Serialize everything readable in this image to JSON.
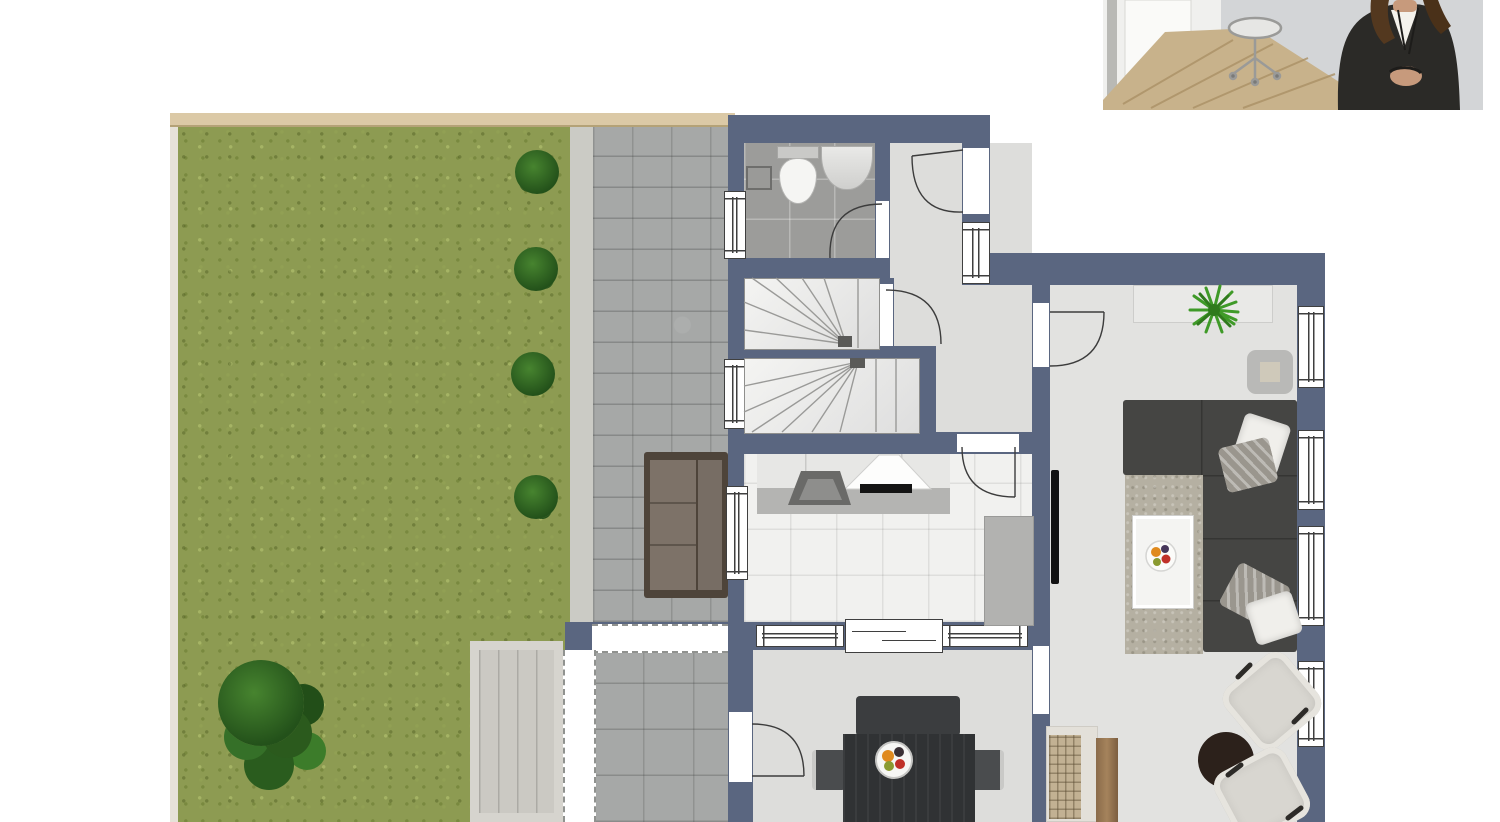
{
  "meta": {
    "kind": "real-estate ground-floor plan with garden and furnished rooms, agent photo inset top-right",
    "visible_text": "none"
  },
  "colors": {
    "wall": "#5a6680",
    "floor": "#dddddb",
    "floorLiving": "#e2e2e0",
    "bathTile": "#9c9c9a",
    "kitchenTile": "#f1f1ef",
    "grass": "#8d9b52",
    "bushDark": "#23511a",
    "bushLight": "#47842f",
    "paver": "#a6a8a7",
    "pathStrip": "#cbcbc5",
    "fence": "#dbc9a6",
    "deck": "#cbc9c3",
    "windowFrame": "#3f3f3f",
    "sofa": "#454543",
    "sofaLine": "#353533",
    "outdoorSofaFrame": "#4e443a",
    "outdoorSofaCushion": "#7d7268",
    "rug": "#b5b0a2",
    "wood": "#8a6b4a",
    "tableDark": "#303234",
    "benchDark": "#3b3d3f",
    "cream": "#d8d6d0",
    "roundTable": "#2c211b",
    "cabinet": "#e7e7e5",
    "counter": "#b4b4b2",
    "appliance": "#b2b2b0",
    "sideboard": "#e9e9e7",
    "tv": "#121212",
    "plantGreen": "#3f9a28",
    "suit": "#2b2a27",
    "skin": "#c79a7c",
    "hair": "#53381f",
    "photoBg": "#d3d5d7",
    "photoFloor": "#c8b28b"
  },
  "photo_inset": {
    "subject": "agent-portrait",
    "elements": [
      "white-interior-wall",
      "office-chair",
      "wood-floor",
      "person-in-dark-suit"
    ]
  },
  "floor_plan": {
    "outdoor": {
      "areas": [
        "lawn",
        "paver-path",
        "terrace",
        "deck-steps",
        "fence-top",
        "overhang-outlines"
      ],
      "plants": {
        "hedge_bushes": 4,
        "large_shrub": 1
      },
      "furniture": [
        "outdoor-sofa"
      ]
    },
    "rooms": [
      {
        "id": "bathroom",
        "fixtures": [
          "toilet",
          "washbasin",
          "wall-cabinet"
        ],
        "windows": 1,
        "doors": 1
      },
      {
        "id": "staircase",
        "flights": 2,
        "windows": 1
      },
      {
        "id": "hallway",
        "doors": [
          "entrance-door",
          "stair-door",
          "kitchen-door",
          "living-room-door"
        ],
        "windows": 1
      },
      {
        "id": "kitchen",
        "fixtures": [
          "upper-cabinets",
          "counter",
          "sink",
          "cooktop-with-hood",
          "appliance-block"
        ],
        "windows": 3,
        "doors": 2
      },
      {
        "id": "dining-room",
        "furniture": [
          "dining-table",
          "bench",
          "side-chairs",
          "fruit-bowl"
        ],
        "doors": [
          "terrace-door",
          "living-room-passage"
        ]
      },
      {
        "id": "living-room",
        "furniture": [
          "sideboard-with-plant",
          "wall-table",
          "corner-sofa",
          "pillows",
          "rug",
          "coffee-table-with-fruit",
          "tv",
          "round-side-table",
          "two-armchairs",
          "lowboard-with-wood"
        ],
        "windows": 4
      }
    ]
  }
}
